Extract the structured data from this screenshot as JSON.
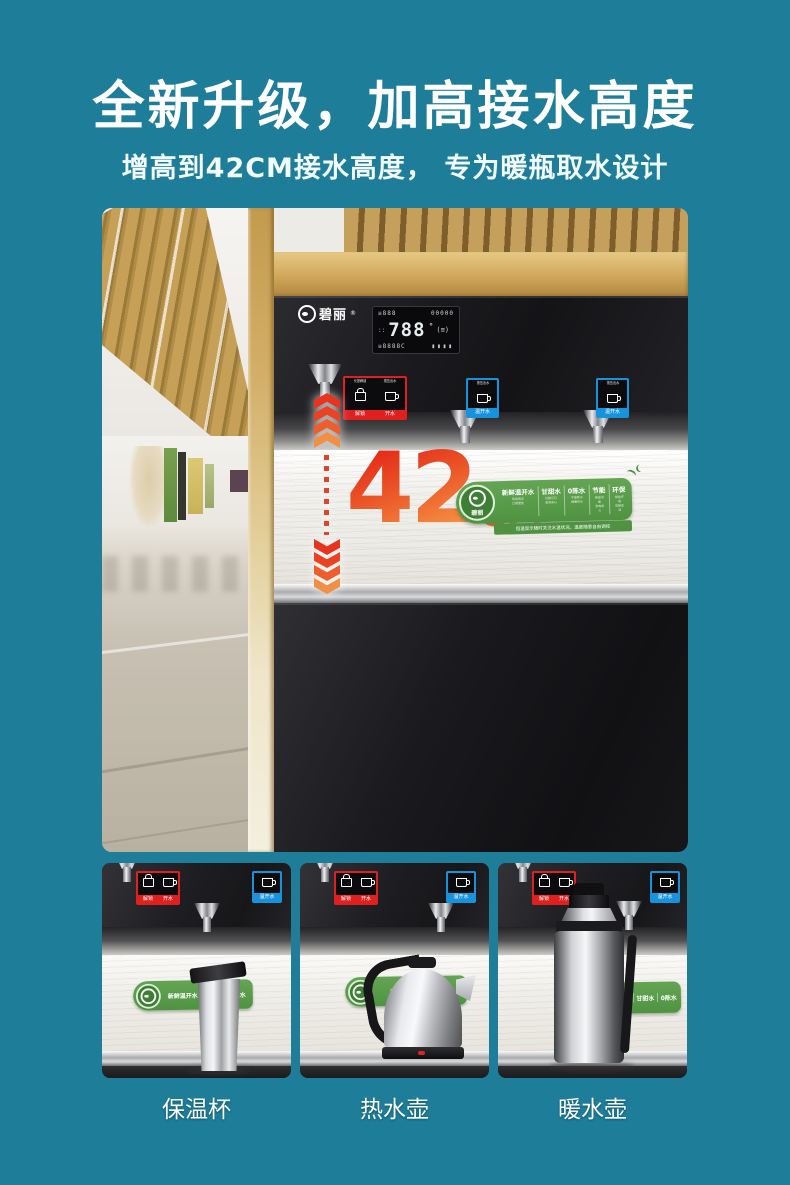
{
  "header": {
    "title": "全新升级，加高接水高度",
    "subtitle": "增高到42CM接水高度， 专为暖瓶取水设计"
  },
  "hero": {
    "brand": "碧丽",
    "brand_reg": "®",
    "display": {
      "top_left": "≡888",
      "top_right": "00000",
      "side": "::",
      "main": "788",
      "degree": "°",
      "right": "(≡)",
      "bottom_left": "≡8888C",
      "bottom_bars": "▮▮▮▮"
    },
    "measure": {
      "value": "42",
      "unit": "CM"
    },
    "dispense_labels": {
      "red": {
        "cells": [
          {
            "top": "长按解锁",
            "name": "解锁"
          },
          {
            "top": "按压出水",
            "name": "开水"
          }
        ]
      },
      "blue": {
        "top": "按压出水",
        "name": "温开水"
      }
    },
    "banner": {
      "brand": "碧丽",
      "features": [
        "新鲜温开水",
        "甘甜水",
        "0陈水",
        "节能",
        "环保"
      ],
      "sub_features": [
        "现烧现饮\n口感更佳",
        "甘甜可口\n滋润身心",
        "不留陈水\n健康饮水",
        "高效节能\n省电省心",
        "绿色环保\n低碳生活"
      ],
      "footer": "恒温显示随时关注水温状况，温度随意自由调控"
    }
  },
  "thumbnails": [
    {
      "caption": "保温杯"
    },
    {
      "caption": "热水壶"
    },
    {
      "caption": "暖水壶"
    }
  ],
  "colors": {
    "background": "#1e7e99",
    "accent_red": "#e02a1e",
    "accent_orange": "#f08a3c",
    "banner_green": "#4f9342",
    "label_red": "#e01f1f",
    "label_blue": "#1792dd"
  }
}
